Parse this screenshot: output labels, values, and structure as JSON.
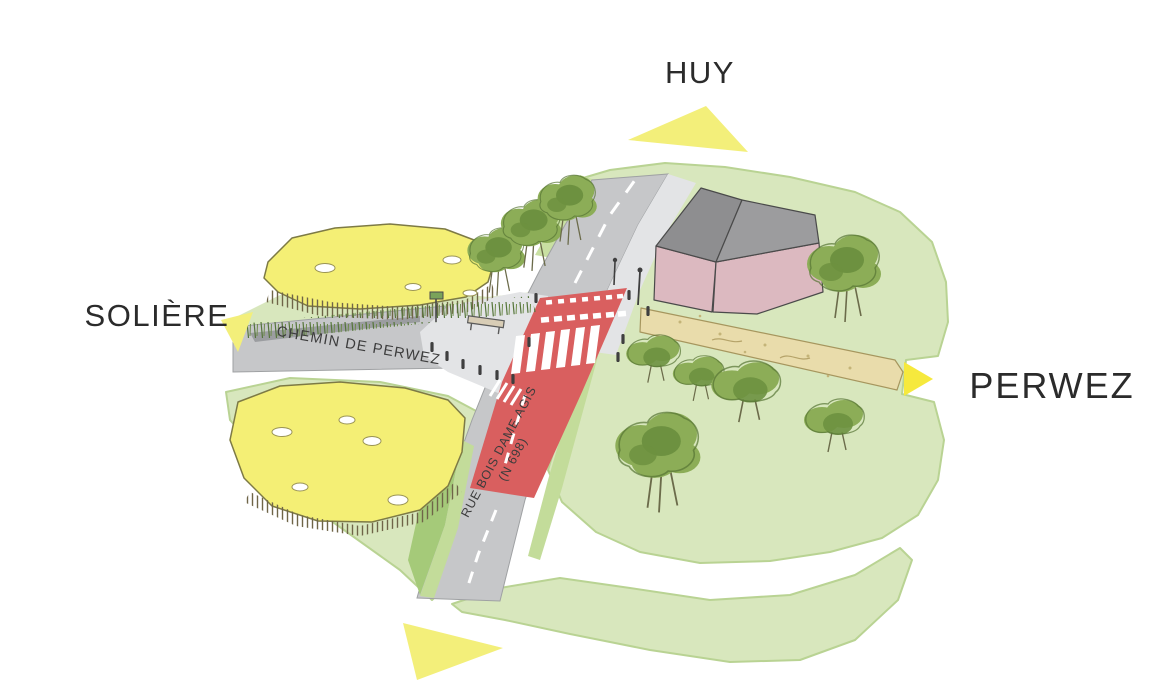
{
  "illustration": {
    "kind": "road-intersection-sketch-plan",
    "labels": {
      "huy": "HUY",
      "soliere": "SOLIÈRE",
      "perwez": "PERWEZ",
      "chemin_de_perwez": "CHEMIN DE PERWEZ",
      "rue_bois_dame_agis": "RUE BOIS DAME AGIS",
      "rue_bois_dame_agis_ref": "(N 698)"
    },
    "colors": {
      "background": "#ffffff",
      "meadow_green": "#d8e7bd",
      "verge_green": "#c9e0a2",
      "slope_green_dark": "#a5ca79",
      "slope_green_light": "#c3dc9a",
      "road_gray": "#c6c7c9",
      "sidewalk_gray": "#e3e4e6",
      "red_surface": "#d95f5f",
      "field_yellow": "#f4ef75",
      "arrow_yellow_pale": "#f3ef7a",
      "arrow_yellow_bright": "#f6e93d",
      "tree_green": "#8cad57",
      "tree_green_dark": "#6d9140",
      "building_wall_pink": "#dcb9c0",
      "building_roof_dark": "#8e8e90",
      "building_roof_light": "#9c9c9e",
      "path_beige": "#e9dcab",
      "label_text": "#2b2b2b"
    },
    "icons": {
      "huy_arrow": "direction-arrow-icon",
      "soliere_arrow": "direction-arrow-icon",
      "perwez_arrow": "direction-arrow-icon",
      "south_arrow": "direction-arrow-icon"
    }
  }
}
